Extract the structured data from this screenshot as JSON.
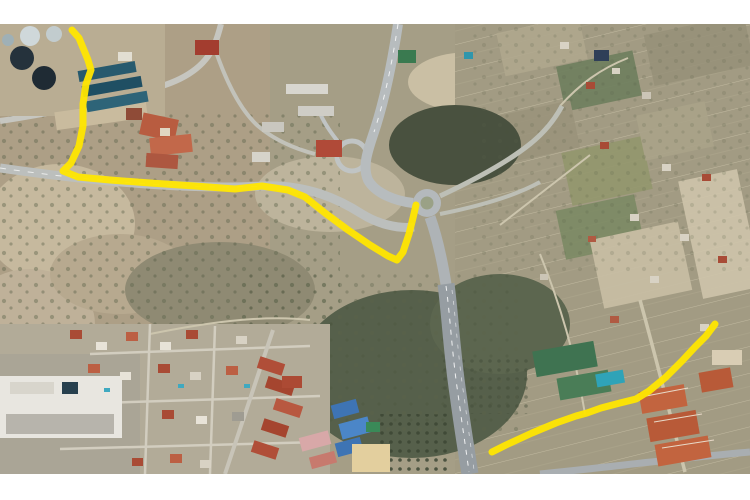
{
  "map": {
    "kind": "satellite-aerial-imagery",
    "features": [
      "water-treatment-plant",
      "highway",
      "highway-interchange",
      "roundabout",
      "orchard-fields",
      "residential-area",
      "school-complex",
      "tennis-courts",
      "scrubland"
    ]
  },
  "palette": {
    "letterbox": "#ffffff",
    "terrain_base": "#a59e86",
    "scrub_dark": "#49513f",
    "road": "#c2c5c3",
    "route": "#ffe600"
  },
  "route_overlay": {
    "color": "#ffe600",
    "stroke_width": 7,
    "segments": [
      {
        "name": "route-segment-northwest",
        "points": [
          [
            72,
            6
          ],
          [
            79,
            14
          ],
          [
            88,
            36
          ],
          [
            91,
            46
          ],
          [
            86,
            60
          ],
          [
            83,
            80
          ],
          [
            83,
            102
          ],
          [
            79,
            122
          ],
          [
            71,
            139
          ],
          [
            63,
            147
          ],
          [
            78,
            153
          ],
          [
            110,
            156
          ],
          [
            150,
            159
          ],
          [
            195,
            162
          ],
          [
            235,
            165
          ],
          [
            262,
            162
          ],
          [
            288,
            166
          ],
          [
            305,
            173
          ],
          [
            325,
            189
          ],
          [
            348,
            206
          ],
          [
            370,
            221
          ],
          [
            388,
            232
          ],
          [
            397,
            236
          ],
          [
            403,
            228
          ],
          [
            409,
            210
          ],
          [
            413,
            194
          ],
          [
            416,
            181
          ]
        ]
      },
      {
        "name": "route-segment-southeast",
        "points": [
          [
            492,
            428
          ],
          [
            506,
            421
          ],
          [
            532,
            409
          ],
          [
            556,
            399
          ],
          [
            576,
            392
          ],
          [
            587,
            389
          ],
          [
            601,
            384
          ],
          [
            620,
            379
          ],
          [
            636,
            375
          ],
          [
            649,
            367
          ],
          [
            666,
            353
          ],
          [
            682,
            337
          ],
          [
            695,
            323
          ],
          [
            706,
            312
          ],
          [
            715,
            300
          ]
        ]
      }
    ]
  }
}
